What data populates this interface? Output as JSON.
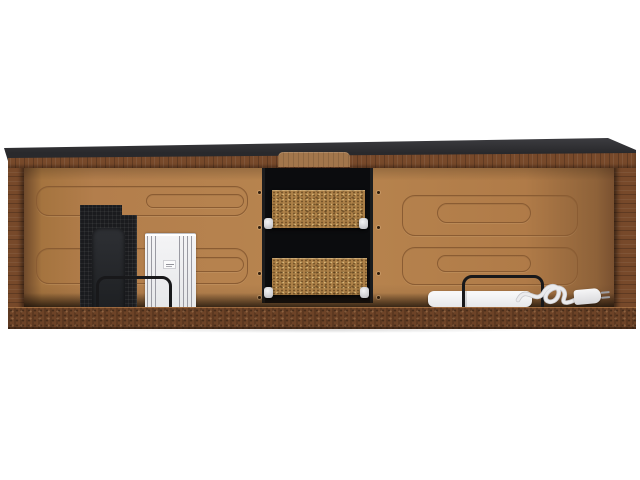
{
  "meta": {
    "description": "Product photo on white background: wide TV-stand carcass seen from the open back, dark grey top over walnut-brown wood frame, tan hardboard back panel with embossed rounded-rectangle stiffening pattern, centre black drawer compartment with two particleboard drawer backs on white rollers, packed parts leaning inside: black speaker mesh panel, stack of white panels with small sticker, two black wire brackets, white power strip bar and coiled white power cord with plug",
    "background": "#ffffff"
  },
  "colors": {
    "background": "#ffffff",
    "top-dark": "#29292c",
    "top-dark-light": "#3f3f43",
    "wood": "#77492a",
    "wood-dark": "#6d4327",
    "wood-light": "#a2764b",
    "backpanel": "#b37e4c",
    "backpanel-shadow": "#7a5130",
    "emboss-line": "#8a5c33",
    "compartment": "#0b0c0e",
    "board": "#ac8047",
    "roller": "#f4f4f5",
    "mesh-panel": "#1a1b1e",
    "mesh-inner": "#2e3034",
    "white-part": "#e6e7e9",
    "white-part-line": "#9a9aa2",
    "bracket": "#18181a",
    "cord": "#ebebed",
    "prong": "#9d9da1"
  },
  "parts": {
    "carcass": {
      "name": "tv-stand-carcass"
    },
    "mesh_panel": {
      "name": "speaker-mesh-panel"
    },
    "panel_stack": {
      "name": "white-panel-stack",
      "has_sticker": true
    },
    "bracket_left": {
      "name": "wire-bracket"
    },
    "compartment": {
      "name": "drawer-compartment",
      "drawer_backs": 2,
      "rollers": 4
    },
    "bracket_right": {
      "name": "wire-bracket"
    },
    "power_strip": {
      "name": "power-strip-bar"
    },
    "cord": {
      "name": "power-cord-with-plug"
    }
  }
}
